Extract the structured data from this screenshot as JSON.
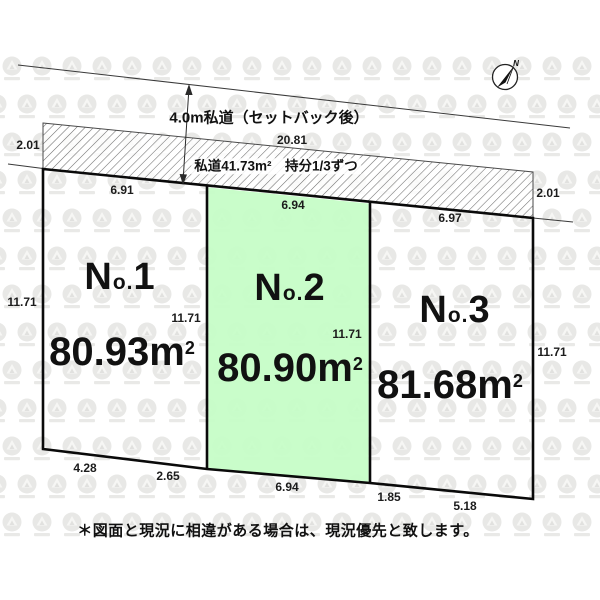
{
  "diagram": {
    "road": {
      "width_label": "4.0m私道（セットバック後）",
      "length": "20.81",
      "area_share_label": "私道41.73m²　持分1/3ずつ"
    },
    "compass": {
      "north": "N"
    },
    "plots": [
      {
        "n": "N",
        "o": "o.",
        "number": "1",
        "area_value": "80.93",
        "area_unit": "m",
        "area_sup": "2"
      },
      {
        "n": "N",
        "o": "o.",
        "number": "2",
        "area_value": "80.90",
        "area_unit": "m",
        "area_sup": "2"
      },
      {
        "n": "N",
        "o": "o.",
        "number": "3",
        "area_value": "81.68",
        "area_unit": "m",
        "area_sup": "2"
      }
    ],
    "dimensions": {
      "setback_left": "2.01",
      "setback_right": "2.01",
      "no1_top": "6.91",
      "no2_top": "6.94",
      "no3_top": "6.97",
      "no1_left": "11.71",
      "no1_right": "11.71",
      "no2_right": "11.71",
      "no3_right": "11.71",
      "no1_bottom_left": "4.28",
      "no1_bottom_right": "2.65",
      "no2_bottom": "6.94",
      "no3_bottom_left": "1.85",
      "no3_bottom_right": "5.18"
    },
    "note": "＊図面と現況に相違がある場合は、現況優先と致します。"
  }
}
